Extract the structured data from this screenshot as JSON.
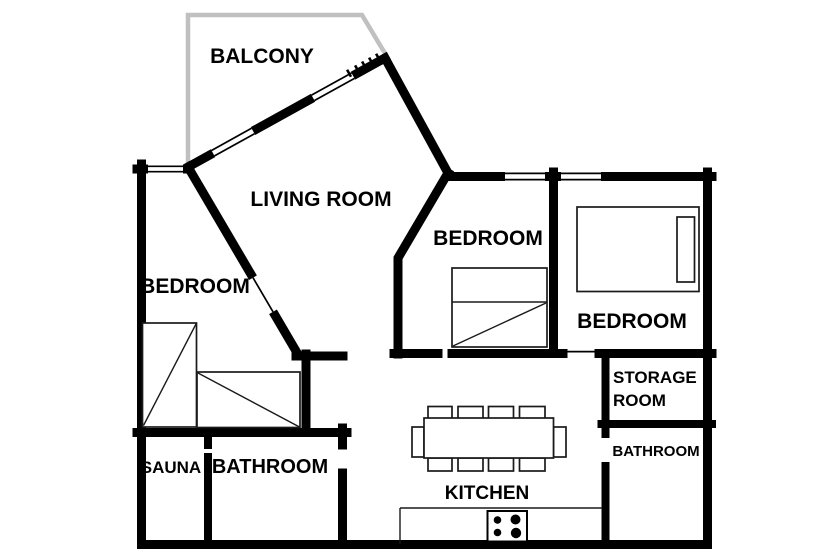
{
  "floorplan": {
    "type": "apartment-floor-plan",
    "rooms": [
      {
        "id": "balcony",
        "label": "BALCONY"
      },
      {
        "id": "living-room",
        "label": "LIVING ROOM"
      },
      {
        "id": "bedroom-left",
        "label": "BEDROOM"
      },
      {
        "id": "bedroom-middle",
        "label": "BEDROOM"
      },
      {
        "id": "bedroom-right",
        "label": "BEDROOM"
      },
      {
        "id": "sauna",
        "label": "SAUNA"
      },
      {
        "id": "bathroom-left",
        "label": "BATHROOM"
      },
      {
        "id": "storage-room",
        "label": "STORAGE ROOM",
        "lines": [
          "STORAGE",
          "ROOM"
        ]
      },
      {
        "id": "bathroom-right",
        "label": "BATHROOM"
      },
      {
        "id": "kitchen",
        "label": "KITCHEN"
      }
    ],
    "furniture": {
      "beds": 4,
      "dining_table_chairs": 10,
      "stove_burners": 4
    },
    "colors": {
      "wall": "#000000",
      "balcony_wall": "#c0c0c0",
      "background": "#ffffff",
      "furniture_line": "#1a1a1a"
    }
  }
}
